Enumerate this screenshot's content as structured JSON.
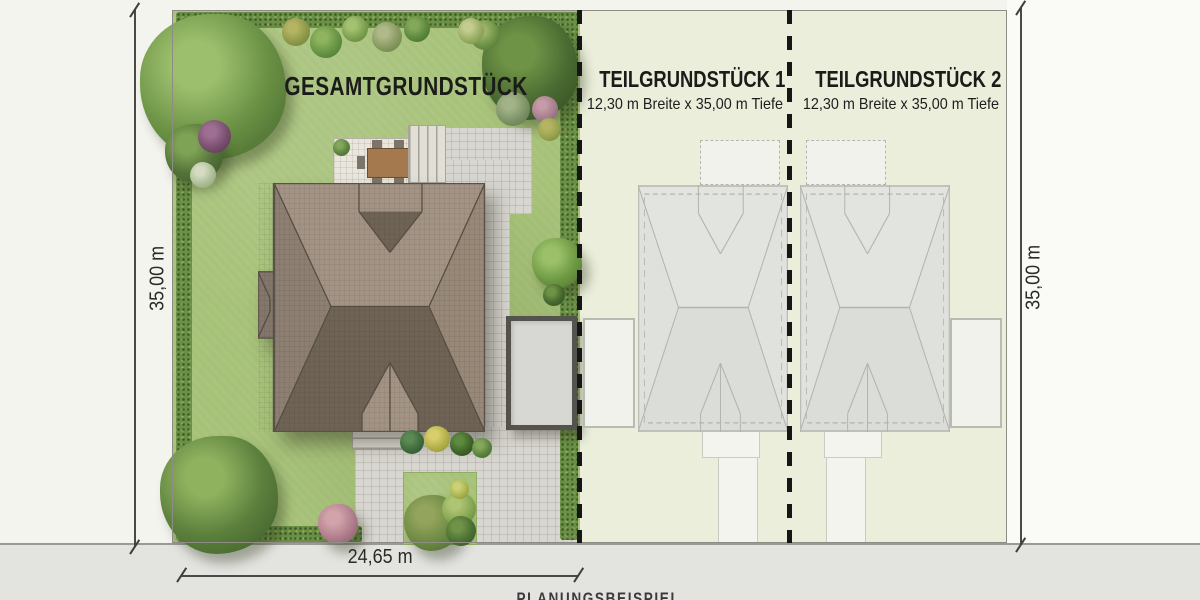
{
  "plan": {
    "main_label": "GESAMTGRUNDSTÜCK",
    "plot1": {
      "title": "TEILGRUNDSTÜCK 1",
      "subtitle": "12,30 m Breite x 35,00 m Tiefe"
    },
    "plot2": {
      "title": "TEILGRUNDSTÜCK 2",
      "subtitle": "12,30 m Breite x 35,00 m Tiefe"
    },
    "dim_left": "35,00 m",
    "dim_right": "35,00 m",
    "dim_bottom": "24,65 m",
    "cutoff_caption": "PLANUNGSBEISPIEL"
  },
  "colors": {
    "lawn": "#a6c178",
    "hedge": "#6a8f45",
    "plot2_background": "#eaeedb",
    "roof_light": "#a29384",
    "roof_dark": "#6f6355",
    "pavers": "#d8d6d0",
    "street": "#e3e3e0",
    "dashed_divider": "#161616",
    "ghost_outline": "#b2b5ad"
  }
}
